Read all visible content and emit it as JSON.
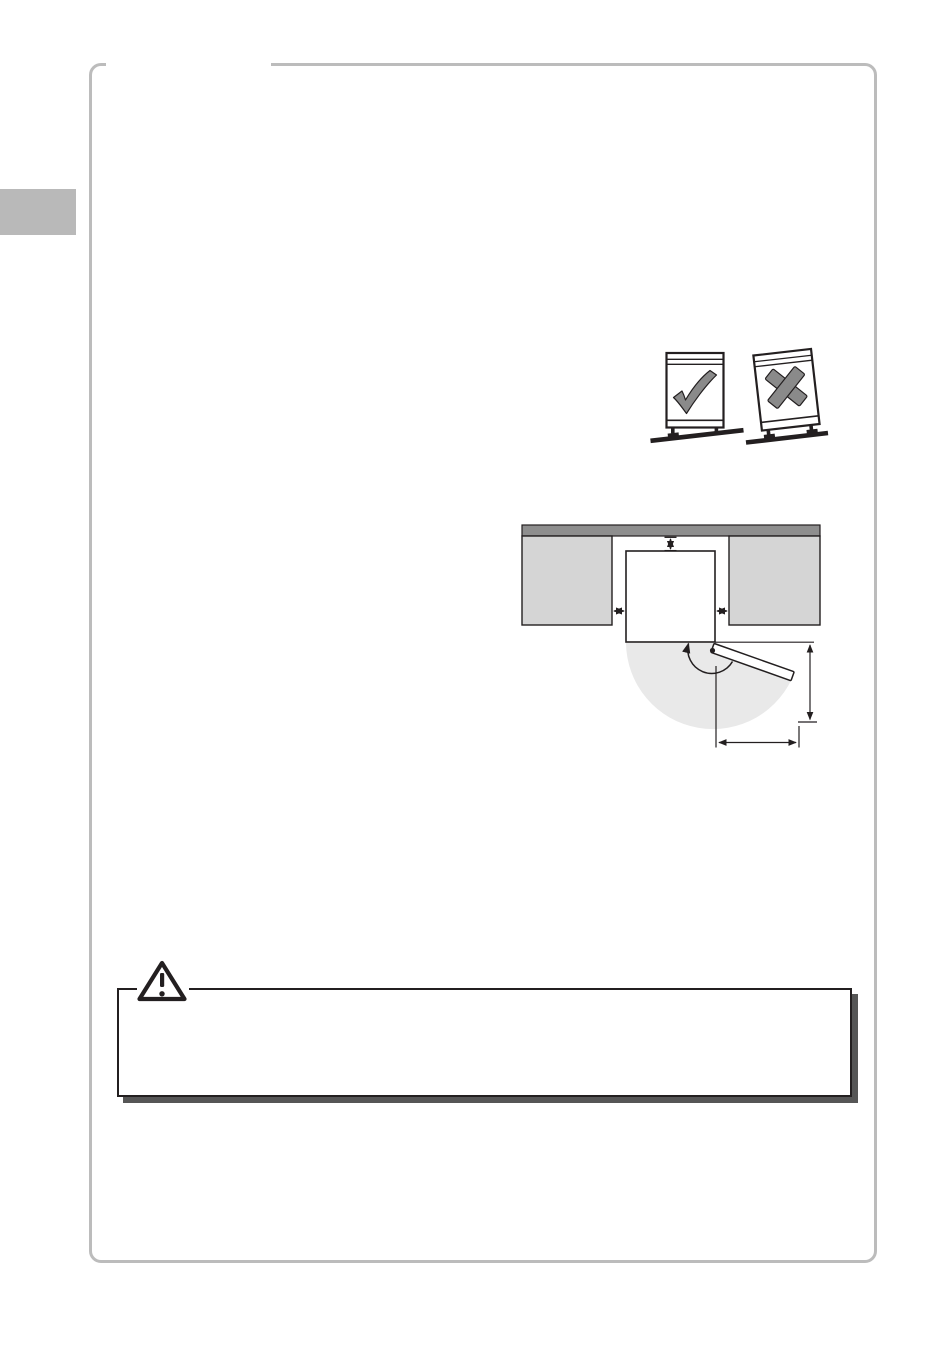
{
  "page": {
    "width_px": 950,
    "height_px": 1347,
    "background": "#ffffff",
    "border_color": "#bcbcbc",
    "side_tab_color": "#b9b9b9",
    "ink_color": "#231f20",
    "visible_text": ""
  },
  "figures": {
    "leveling": {
      "ok_mark_icon": "checkmark-icon",
      "bad_mark_icon": "cross-icon",
      "mark_color": "#8a8a8a",
      "appliance_fill": "#ffffff"
    },
    "clearance": {
      "wall_color": "#8e8e8e",
      "cabinet_color": "#d5d5d5",
      "appliance_fill": "#ffffff",
      "door_swing_color": "#e9e9e9"
    },
    "warning": {
      "icon": "warning-triangle-icon",
      "box_fill": "#ffffff",
      "box_border_color": "#231f20",
      "shadow_color": "#565656"
    }
  }
}
